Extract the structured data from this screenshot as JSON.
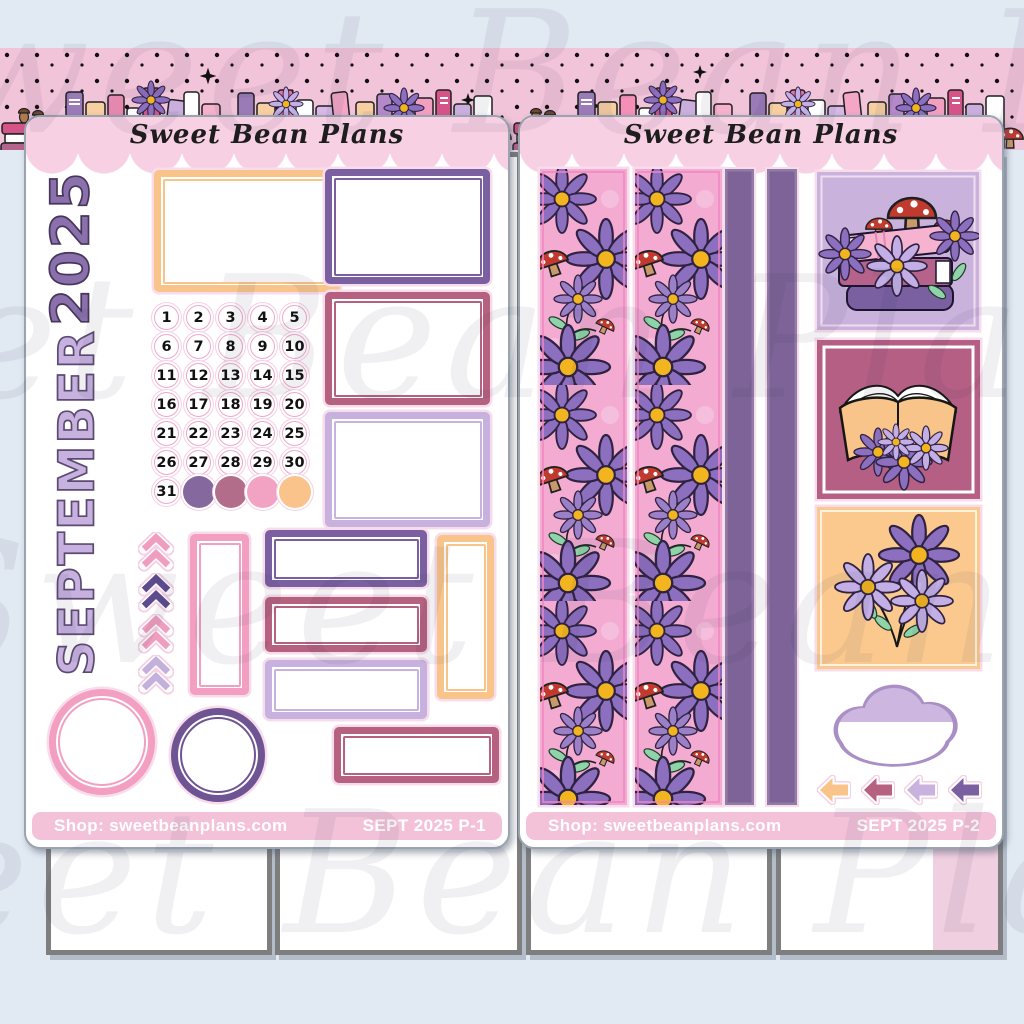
{
  "brand": {
    "name": "Sweet Bean Plans"
  },
  "watermark_text": "Sweet Bean Plans",
  "palette": {
    "bg": "#e1e9f3",
    "band_pink": "#f2c4da",
    "header_pink": "#f8d0e4",
    "bar_pink": "#f3c2d9",
    "purple_dark": "#7a5fa1",
    "purple_deep": "#6f5494",
    "lavender": "#c7b2df",
    "mauve": "#b5617f",
    "pink": "#f29fc2",
    "peach": "#f9c489",
    "washi_pink": "#f3abd2",
    "daisy_purple": "#8d6fc0",
    "daisy_lavender": "#c3aee6",
    "leaf_green": "#8fd4a8",
    "mushroom_red": "#c03a30",
    "grey_box_border": "#7e7e7e",
    "sheet_border": "#9aa3ae"
  },
  "sheets": [
    {
      "header_script": "Sweet Bean Plans",
      "year": "2025",
      "month": "SEPTEMBER",
      "dates": [
        "1",
        "2",
        "3",
        "4",
        "5",
        "6",
        "7",
        "8",
        "9",
        "10",
        "11",
        "12",
        "13",
        "14",
        "15",
        "16",
        "17",
        "18",
        "19",
        "20",
        "21",
        "22",
        "23",
        "24",
        "25",
        "26",
        "27",
        "28",
        "29",
        "30",
        "31"
      ],
      "dot_colors": [
        "#84689e",
        "#b26d8b",
        "#f2a3c4",
        "#f9c38b"
      ],
      "chevron_colors": [
        "#f09ec0",
        "#5c4b8f",
        "#f09ec0",
        "#c3b1dc"
      ],
      "footer_shop": "Shop: sweetbeanplans.com",
      "footer_code": "SEPT 2025 P-1"
    },
    {
      "header_script": "Sweet Bean Plans",
      "arrow_colors": [
        "#f9c489",
        "#b5617f",
        "#c9b2de",
        "#7a5fa1"
      ],
      "footer_shop": "Shop: sweetbeanplans.com",
      "footer_code": "SEPT 2025 P-2"
    }
  ]
}
